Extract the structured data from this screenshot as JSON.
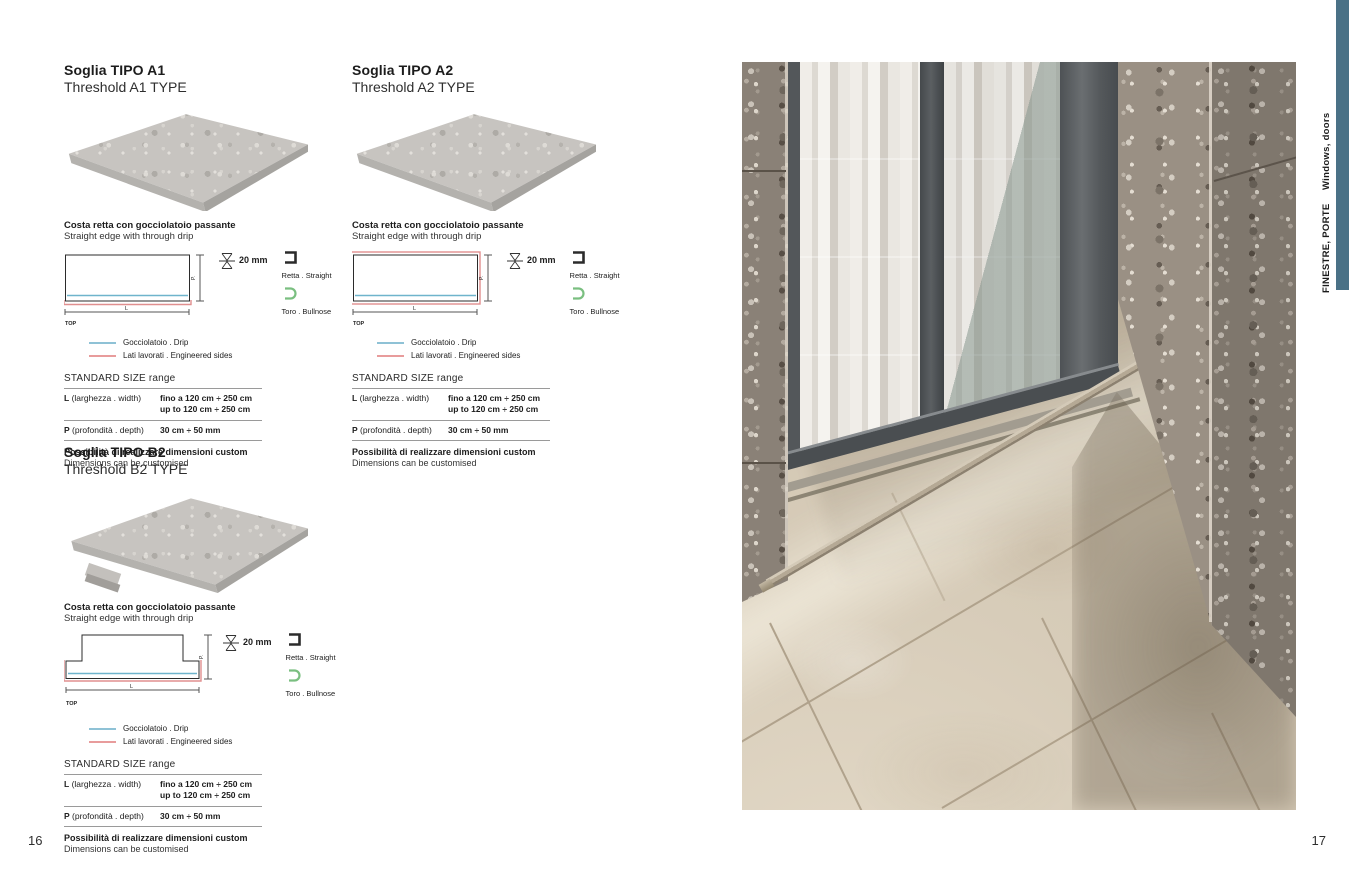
{
  "page": {
    "number_left": "16",
    "number_right": "17"
  },
  "sidebar": {
    "category_it": "FINESTRE, PORTE",
    "category_en": "Windows, doors",
    "bar_color": "#4a7186"
  },
  "sections": {
    "a1": {
      "title_it": "Soglia TIPO A1",
      "title_en": "Threshold A1 TYPE"
    },
    "a2": {
      "title_it": "Soglia TIPO A2",
      "title_en": "Threshold A2 TYPE"
    },
    "b2": {
      "title_it": "Soglia TIPO B2",
      "title_en": "Threshold B2 TYPE"
    }
  },
  "shared": {
    "edge_title_it": "Costa retta con gocciolatoio passante",
    "edge_title_en": "Straight edge with through drip",
    "thickness_label": "20 mm",
    "profile_straight": "Retta . Straight",
    "profile_bullnose": "Toro . Bullnose",
    "legend_drip": "Gocciolatoio . Drip",
    "legend_sides": "Lati lavorati . Engineered sides",
    "size_range_title": "STANDARD SIZE range",
    "width_label": "L",
    "width_sublabel": "(larghezza . width)",
    "width_value_it": "fino a 120 cm ÷ 250 cm",
    "width_value_en": "up to 120 cm ÷ 250 cm",
    "depth_label": "P",
    "depth_sublabel": "(profondità . depth)",
    "depth_value": "30 cm ÷ 50 mm",
    "custom_note_it": "Possibilità di realizzare dimensioni custom",
    "custom_note_en": "Dimensions can be customised",
    "drawing": {
      "top_label": "TOP",
      "length_label": "L",
      "depth_axis_label": "P."
    },
    "colors": {
      "drip": "#6fb4cc",
      "engineered_sides": "#e08f8f",
      "bullnose": "#7abf80",
      "straight": "#2b2b2b"
    }
  }
}
